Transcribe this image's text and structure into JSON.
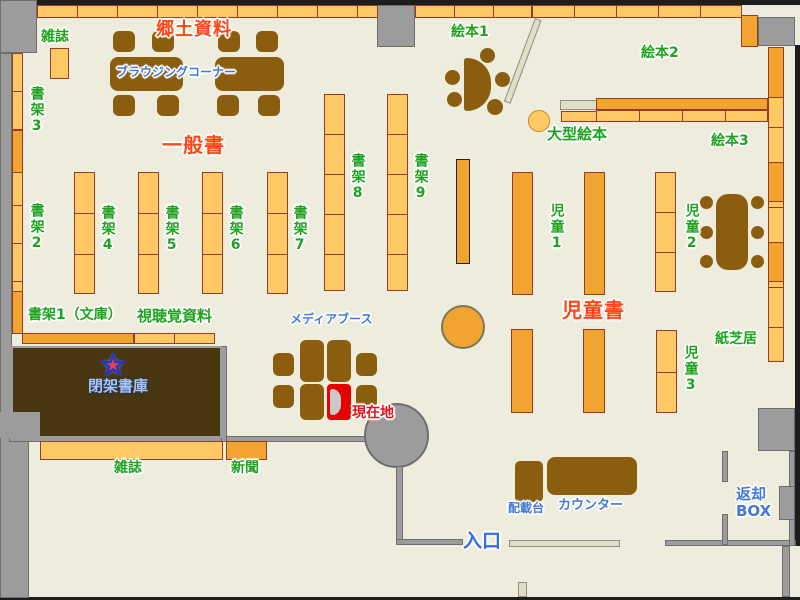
{
  "colors": {
    "floor": "#EDECDD",
    "wall": "#9C9C9C",
    "wall-edge": "#6E6E6E",
    "shelf-light": "#FFC966",
    "shelf-dark": "#F2A430",
    "shelf-border": "#963C28",
    "furniture": "#8B5E0F",
    "stacks-room": "#47360F",
    "light-wall": "#E2DEC6",
    "label-green": "#1FA31F",
    "label-red": "#FF4716",
    "label-blue": "#4379D8",
    "label-lightblue": "#A9C6F2",
    "entrance-blue": "#2E6FE8",
    "current-red": "#E8101C",
    "current-box": "#E80000",
    "star-red": "#E84048",
    "star-blue": "#2438C8"
  },
  "labels": {
    "magazines_top": "雑誌",
    "local_materials": "郷土資料",
    "browsing_corner": "ブラウジングコーナー",
    "shelf3": "書架3",
    "shelf2": "書架2",
    "general_books": "一般書",
    "shelf4": "書架4",
    "shelf5": "書架5",
    "shelf6": "書架6",
    "shelf7": "書架7",
    "shelf8": "書架8",
    "shelf9": "書架9",
    "picture_books_1": "絵本1",
    "picture_books_2": "絵本2",
    "picture_books_3": "絵本3",
    "large_picture_books": "大型絵本",
    "children_1": "児童1",
    "children_2": "児童2",
    "children_3": "児童3",
    "children_books": "児童書",
    "kamishibai": "紙芝居",
    "shelf1_bunko": "書架1（文庫）",
    "audiovisual": "視聴覚資料",
    "closed_stacks": "閉架書庫",
    "media_booth": "メディアブース",
    "current_location": "現在地",
    "magazines_bottom": "雑誌",
    "newspapers": "新聞",
    "sorting_desk": "配載台",
    "counter": "カウンター",
    "entrance": "入口",
    "return_box": "返却\nBOX"
  },
  "icons": {
    "current-location-star": "★"
  }
}
